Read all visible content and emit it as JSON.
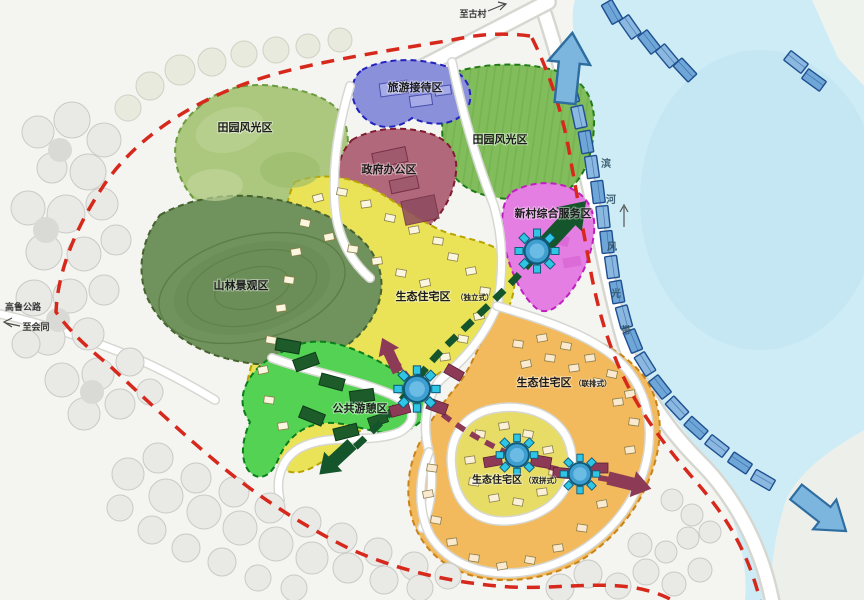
{
  "annotations": {
    "to_gucun": "至古村",
    "highway_name": "高鲁公路",
    "to_huitong": "至会同",
    "river_belt_chars": [
      "滨",
      "河",
      "风",
      "光",
      "带"
    ]
  },
  "zones": {
    "field_left": {
      "label": "田园风光区",
      "color": "#abc87e"
    },
    "field_right": {
      "label": "田园风光区",
      "color": "#82bd5c"
    },
    "tourism": {
      "label": "旅游接待区",
      "color": "#8b90da"
    },
    "government": {
      "label": "政府办公区",
      "color": "#b2687b"
    },
    "mountain": {
      "label": "山林景观区",
      "color": "#70925c"
    },
    "service": {
      "label": "新村综合服务区",
      "color": "#e47ee2"
    },
    "eco_detached": {
      "label": "生态住宅区",
      "suffix": "（独立式）",
      "color": "#eae257"
    },
    "recreation": {
      "label": "公共游憩区",
      "color": "#53d253"
    },
    "eco_townhouse": {
      "label": "生态住宅区",
      "suffix": "（联排式）",
      "color": "#f2ba5c"
    },
    "eco_semi": {
      "label": "生态住宅区",
      "suffix": "（双拼式）",
      "color": "#e7dd66"
    }
  },
  "colors": {
    "water": "#cdecf6",
    "boundary": "#d7281c",
    "flow_blue": "#7cb5de",
    "flow_green": "#15552b",
    "flow_maroon": "#8c3a55",
    "waterfront_building": "#6fa6d8"
  }
}
